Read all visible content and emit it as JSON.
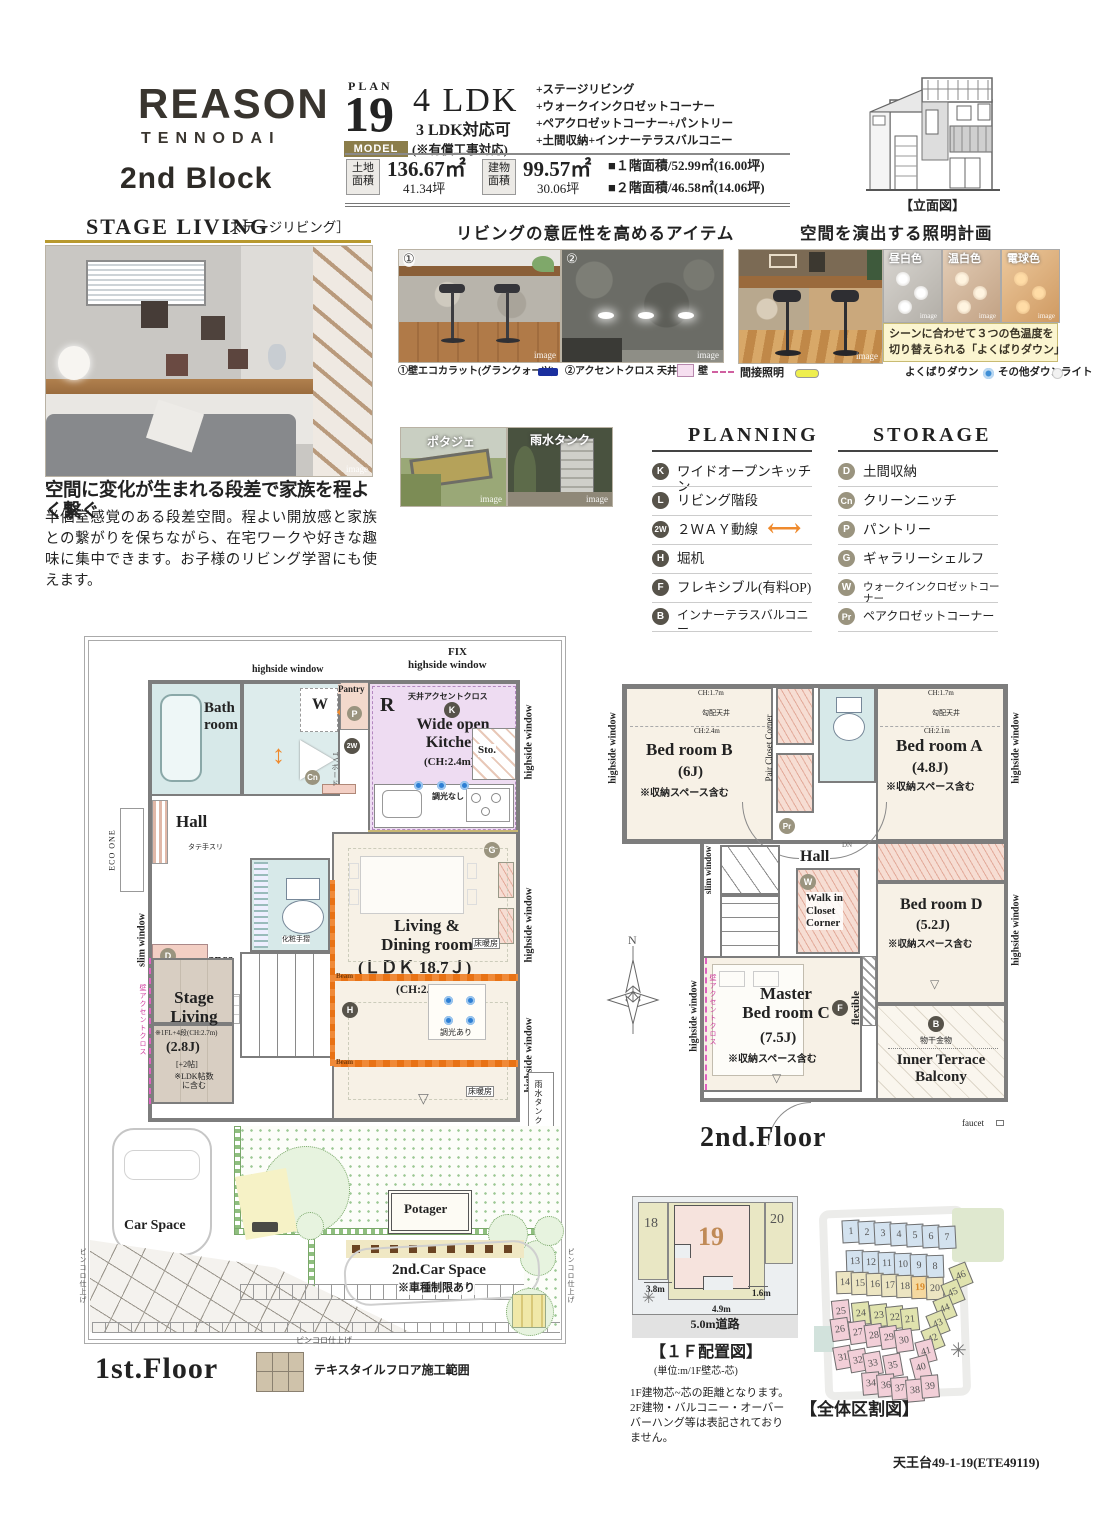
{
  "header": {
    "brand": "REASON",
    "brand_sub": "TENNODAI",
    "block": "2nd Block",
    "plan_label": "PLAN",
    "plan_number": "19",
    "model": "MODEL",
    "ldk": "4 LDK",
    "ldk_alt": "3 LDK対応可",
    "ldk_alt_note": "(※有償工事対応)",
    "features": [
      "+ステージリビング",
      "+ウォークインクロゼットコーナー",
      "+ペアクロゼットコーナー+パントリー",
      "+土間収納+インナーテラスバルコニー"
    ],
    "land_label": "土地\n面積",
    "land_m2": "136.67㎡",
    "land_tsubo": "41.34坪",
    "bldg_label": "建物\n面積",
    "bldg_m2": "99.57㎡",
    "bldg_tsubo": "30.06坪",
    "f1_area": "■１階面積/52.99㎡(16.00坪)",
    "f2_area": "■２階面積/46.58㎡(14.06坪)",
    "elevation_caption": "【立面図】"
  },
  "stage": {
    "title": "STAGE LIVING",
    "title_jp": "［ステージリビング］",
    "img": "image",
    "headline": "空間に変化が生まれる段差で家族を程よく繋ぐ",
    "body": "半個室感覚のある段差空間。程よい開放感と家族との繋がりを保ちながら、在宅ワークや好きな趣味に集中できます。お子様のリビング学習にも使えます。"
  },
  "items": {
    "title": "リビングの意匠性を高めるアイテム",
    "n1": "①",
    "n2": "②",
    "img": "image",
    "legend1": "①壁エコカラット(グランクォーツ)",
    "legend2": "②アクセントクロス 天井",
    "legend2_wall": "壁",
    "small1": "ポタジェ",
    "small2": "雨水タンク"
  },
  "light": {
    "title": "空間を演出する照明計画",
    "img": "image",
    "sw": [
      "昼白色",
      "温白色",
      "電球色"
    ],
    "note1": "シーンに合わせて３つの色温度を",
    "note2": "切り替えられる「よくばりダウン」",
    "indirect": "間接照明",
    "down": "よくばりダウン",
    "other": "その他ダウンライト"
  },
  "planning": {
    "title": "PLANNING",
    "items": [
      {
        "b": "K",
        "t": "ワイドオープンキッチン"
      },
      {
        "b": "L",
        "t": "リビング階段"
      },
      {
        "b": "2W",
        "t": "２ＷＡＹ動線"
      },
      {
        "b": "H",
        "t": "堀机"
      },
      {
        "b": "F",
        "t": "フレキシブル(有料OP)"
      },
      {
        "b": "B",
        "t": "インナーテラスバルコニー"
      }
    ]
  },
  "storage": {
    "title": "STORAGE",
    "items": [
      {
        "b": "D",
        "t": "土間収納"
      },
      {
        "b": "Cn",
        "t": "クリーンニッチ"
      },
      {
        "b": "P",
        "t": "パントリー"
      },
      {
        "b": "G",
        "t": "ギャラリーシェルフ"
      },
      {
        "b": "W",
        "t": "ウォークインクロゼットコーナー"
      },
      {
        "b": "Pr",
        "t": "ペアクロゼットコーナー"
      }
    ]
  },
  "f1": {
    "fix": "FIX",
    "hw": "highside window",
    "slim": "slim window",
    "bath": "Bath\nroom",
    "w": "W",
    "cn": "Cn",
    "pantry": "Pantry",
    "p": "P",
    "two_w": "2W",
    "r": "R",
    "ceiling_accent": "天井アクセントクロス",
    "k": "K",
    "kitchen": "Wide open\nKitchen",
    "kitchen_ch": "(CH:2.4m)",
    "sto": "Sto.",
    "dim_off": "調光なし",
    "ecarat": "エコカラット(グランクォーツ)",
    "indirect": "間接照明",
    "tv": "TVボード",
    "hall": "Hall",
    "tatetesuri": "タテ手スリ",
    "eco_one": "ECO ONE",
    "d": "D",
    "doma": "Doma",
    "entrance": "Entrance",
    "keshou": "化粧手摺",
    "up": "UP",
    "l": "L",
    "h": "H",
    "g": "G",
    "stage1": "Stage\nLiving",
    "stage2": "※1FL+4段(CH:2.7m)",
    "stage3": "(2.8J)",
    "stage4": "[+2帖]",
    "stage5": "※LDK帖数\nに含む",
    "wall_accent": "壁アクセントクロス",
    "ld1": "Living &\nDining room",
    "ld2": "(ＬＤＫ 18.7Ｊ)",
    "ld3": "(CH:2.7m)",
    "beam": "Beam",
    "floor_heat": "床暖房",
    "dim_on": "調光あり",
    "rain_tank": "雨水タンク",
    "shutter": "電動シャッター",
    "car": "Car Space",
    "potager": "Potager",
    "car2": "2nd.Car Space",
    "car2n": "※車種制限あり",
    "pincoro": "ピンコロ仕上げ",
    "floor": "1st.Floor",
    "textile": "テキスタイルフロア施工範囲"
  },
  "f2": {
    "hw": "highside window",
    "slim": "slim window",
    "ch17": "CH:1.7m",
    "slope": "勾配天井",
    "ch24": "CH:2.4m",
    "ch21": "CH:2.1m",
    "bedB1": "Bed room B",
    "bedB2": "(6J)",
    "note": "※収納スペース含む",
    "pair": "Pair Closet Corner",
    "pr": "Pr",
    "bedA1": "Bed room A",
    "bedA2": "(4.8J)",
    "hall": "Hall",
    "dn": "DN",
    "w": "W",
    "walkin": "Walk in\nCloset\nCorner",
    "master1": "Master\nBed room C",
    "master2": "(7.5J)",
    "bedD1": "Bed room D",
    "bedD2": "(5.2J)",
    "f": "F",
    "flex": "flexible",
    "wall_accent": "壁アクセントクロス",
    "b": "B",
    "mono": "物干金物",
    "terrace": "Inner Terrace\nBalcony",
    "faucet": "faucet",
    "floor": "2nd.Floor",
    "n": "N"
  },
  "layout1f": {
    "p18": "18",
    "p19": "19",
    "p20": "20",
    "d1": "3.8m",
    "d2": "1.6m",
    "d3": "4.9m",
    "road": "5.0m道路",
    "caption": "【１Ｆ配置図】",
    "unit": "(単位:m/1F壁芯-芯)",
    "note": "1F建物芯~芯の距離となります。\n2F建物・バルコニー・オーバー\nバーハング等は表記されており\nません。"
  },
  "map": {
    "caption": "【全体区割図】",
    "lots": [
      "1",
      "2",
      "3",
      "4",
      "5",
      "6",
      "7",
      "13",
      "12",
      "11",
      "10",
      "9",
      "8",
      "14",
      "15",
      "16",
      "17",
      "18",
      "19",
      "20",
      "46",
      "45",
      "44",
      "43",
      "42",
      "25",
      "24",
      "23",
      "22",
      "21",
      "26",
      "27",
      "28",
      "29",
      "30",
      "41",
      "40",
      "31",
      "32",
      "33",
      "35",
      "34",
      "36",
      "37",
      "38",
      "39"
    ]
  },
  "footer": "天王台49-1-19(ETE49119)"
}
